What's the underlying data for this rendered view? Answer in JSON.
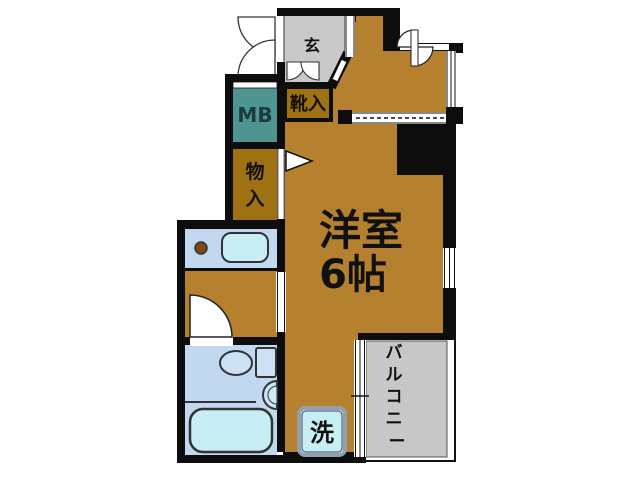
{
  "labels": {
    "entrance": "玄",
    "shoe_cabinet": "靴入",
    "meter_box": "MB",
    "closet_char1": "物",
    "closet_char2": "入",
    "main_room_name": "洋室",
    "main_room_size": "6帖",
    "washer": "洗",
    "balcony_chars": [
      "バ",
      "ル",
      "コ",
      "ニ",
      "ー"
    ]
  },
  "colors": {
    "wall": "#0d0d0d",
    "main_room": "#b5812e",
    "storage": "#9e7112",
    "meter_box": "#4e9491",
    "entrance": "#c9c9c9",
    "balcony": "#c7c7c7",
    "wet_floor": "#c2d8f0",
    "fixture": "#c6eef4",
    "fixture_light": "#cde1f5",
    "washer_border": "#93a0b0",
    "knob": "#7a4a12"
  }
}
